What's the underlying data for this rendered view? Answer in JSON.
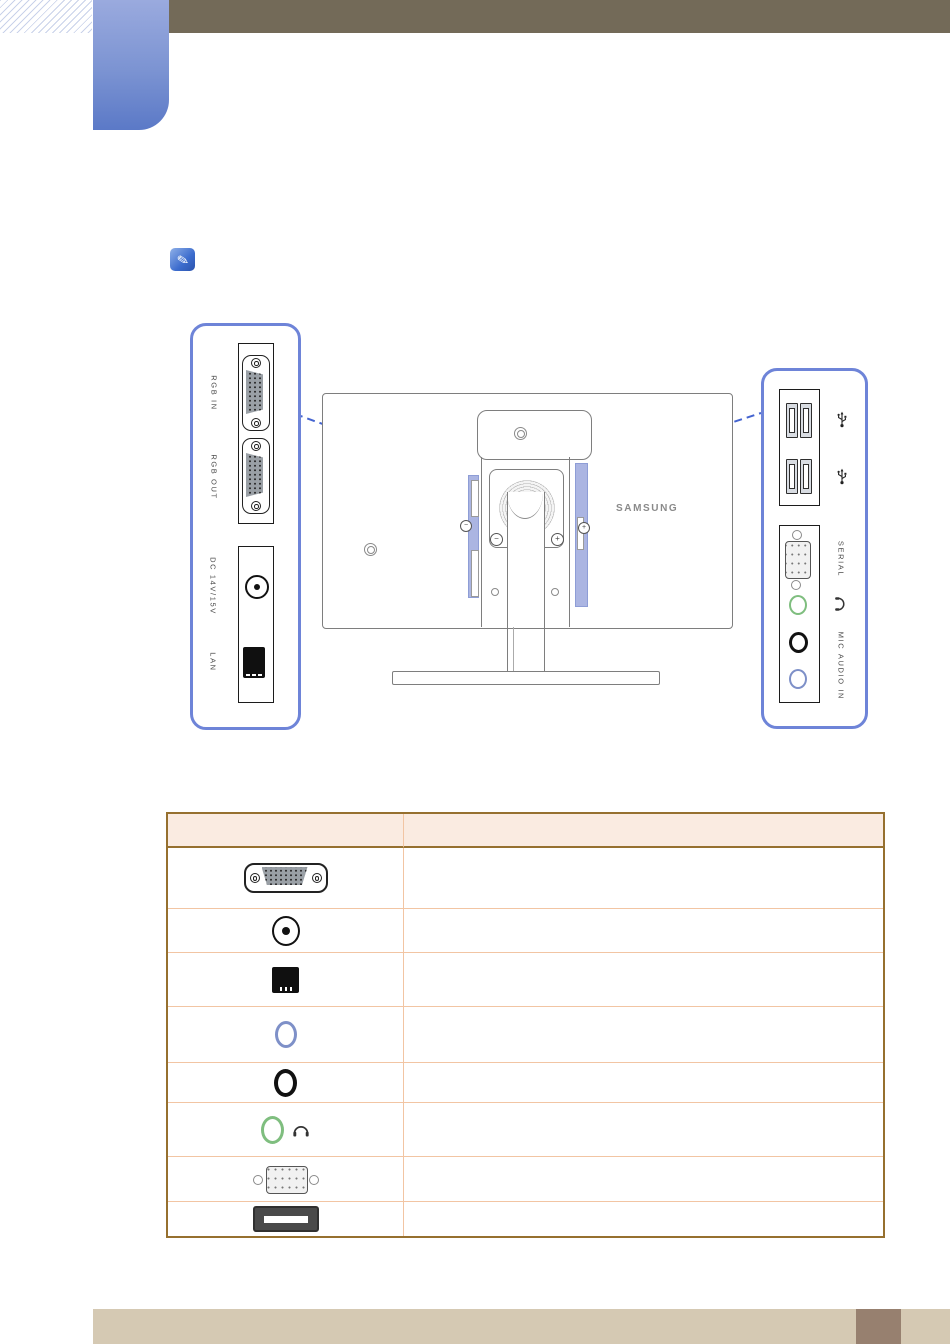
{
  "diagram": {
    "left_panel": {
      "rgb_in_label": "RGB IN",
      "rgb_out_label": "RGB OUT",
      "dc_label": "DC 14V/15V",
      "lan_label": "LAN"
    },
    "right_panel": {
      "serial_label": "SERIAL",
      "mic_label": "MIC",
      "audio_in_label": "AUDIO IN"
    },
    "monitor": {
      "brand": "SAMSUNG"
    }
  },
  "table": {
    "rows": [
      {
        "icon": "vga-connector"
      },
      {
        "icon": "dc-power-jack"
      },
      {
        "icon": "lan-port"
      },
      {
        "icon": "audio-in-jack"
      },
      {
        "icon": "mic-jack"
      },
      {
        "icon": "headphone-jack"
      },
      {
        "icon": "serial-connector"
      },
      {
        "icon": "usb-port"
      }
    ]
  },
  "colors": {
    "top_bar": "#736a58",
    "chapter_tab_top": "#9aaade",
    "chapter_tab_bottom": "#5b79c7",
    "panel_border": "#6e84d8",
    "callout_dash": "#4464d0",
    "port_highlight": "#abb5e2",
    "table_border": "#96702f",
    "table_row_line": "#f2c5a3",
    "table_header_bg": "#faebe1",
    "footer_bar": "#d5c9b3",
    "footer_accent": "#97806f",
    "headphone_jack_green": "#7fbe7f",
    "audio_in_jack_blue": "#7e90c8"
  }
}
